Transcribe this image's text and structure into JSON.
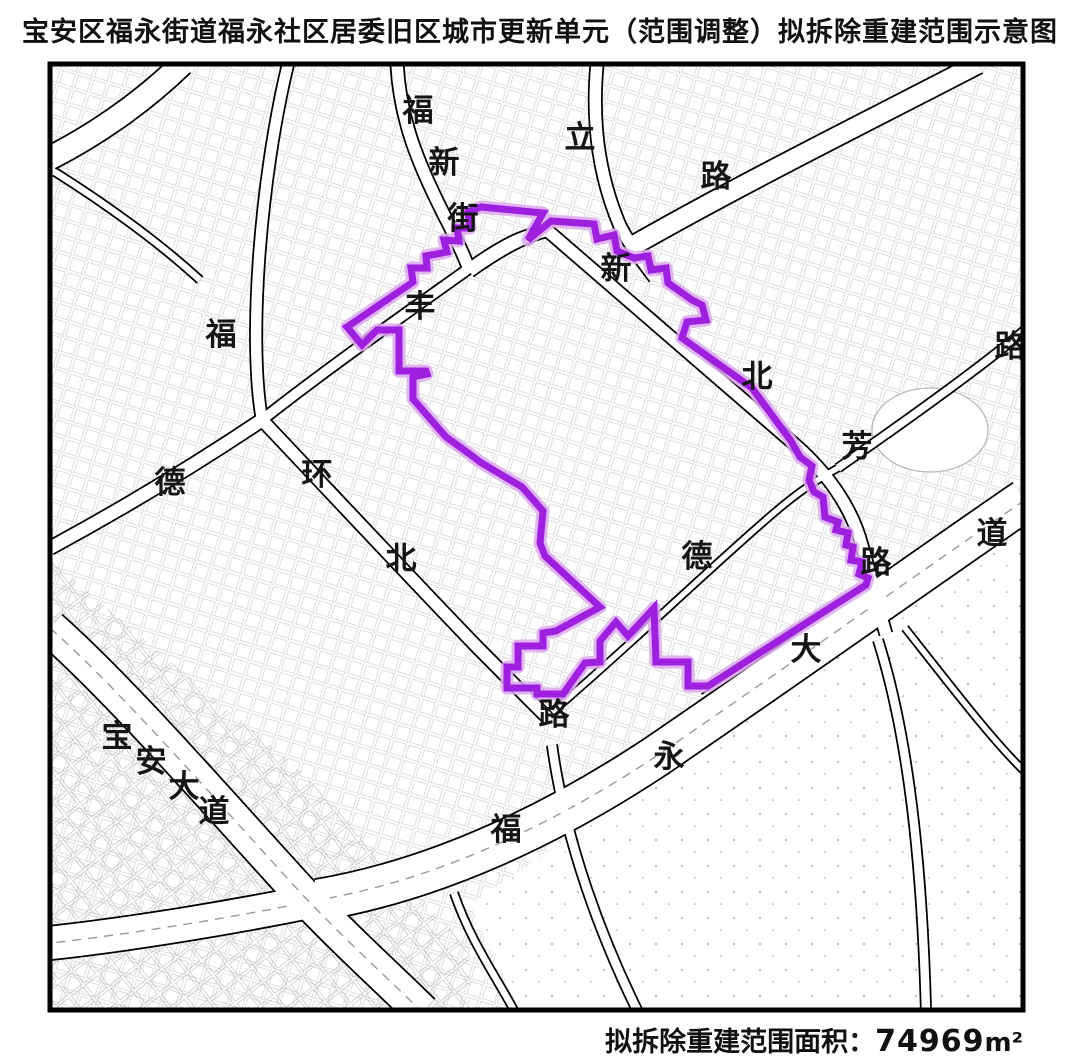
{
  "title": "宝安区福永街道福永社区居委旧区城市更新单元（范围调整）拟拆除重建范围示意图",
  "footer": {
    "area_label": "拟拆除重建范围面积：",
    "area_value": "74969",
    "area_unit": "m²"
  },
  "colors": {
    "boundary_core": "#9F1FDF",
    "boundary_halo": "#DCA8F0",
    "road_casing": "#000000",
    "road_surface": "#ffffff",
    "lane_line": "#999999",
    "label_ink": "#151515"
  },
  "map": {
    "frame": {
      "x": 50,
      "y": 64,
      "width": 973,
      "height": 946
    },
    "boundary": {
      "stroke_width": 7,
      "points": [
        [
          347,
          327
        ],
        [
          413,
          282
        ],
        [
          411,
          268
        ],
        [
          427,
          268
        ],
        [
          426,
          256
        ],
        [
          447,
          252
        ],
        [
          444,
          240
        ],
        [
          459,
          241
        ],
        [
          457,
          228
        ],
        [
          470,
          228
        ],
        [
          468,
          212
        ],
        [
          481,
          207
        ],
        [
          543,
          213
        ],
        [
          528,
          240
        ],
        [
          551,
          221
        ],
        [
          594,
          224
        ],
        [
          597,
          239
        ],
        [
          614,
          235
        ],
        [
          617,
          251
        ],
        [
          634,
          258
        ],
        [
          648,
          256
        ],
        [
          651,
          270
        ],
        [
          666,
          268
        ],
        [
          668,
          283
        ],
        [
          692,
          300
        ],
        [
          702,
          305
        ],
        [
          706,
          320
        ],
        [
          687,
          322
        ],
        [
          682,
          338
        ],
        [
          752,
          388
        ],
        [
          791,
          441
        ],
        [
          800,
          457
        ],
        [
          812,
          466
        ],
        [
          809,
          480
        ],
        [
          814,
          492
        ],
        [
          823,
          497
        ],
        [
          825,
          517
        ],
        [
          838,
          522
        ],
        [
          836,
          530
        ],
        [
          848,
          533
        ],
        [
          846,
          545
        ],
        [
          853,
          547
        ],
        [
          851,
          560
        ],
        [
          862,
          562
        ],
        [
          859,
          574
        ],
        [
          868,
          578
        ],
        [
          866,
          585
        ],
        [
          708,
          686
        ],
        [
          688,
          686
        ],
        [
          688,
          662
        ],
        [
          656,
          662
        ],
        [
          654,
          608
        ],
        [
          642,
          621
        ],
        [
          628,
          636
        ],
        [
          616,
          622
        ],
        [
          600,
          641
        ],
        [
          600,
          662
        ],
        [
          585,
          663
        ],
        [
          563,
          694
        ],
        [
          537,
          694
        ],
        [
          537,
          688
        ],
        [
          507,
          688
        ],
        [
          507,
          667
        ],
        [
          518,
          667
        ],
        [
          518,
          646
        ],
        [
          543,
          646
        ],
        [
          543,
          633
        ],
        [
          556,
          631
        ],
        [
          600,
          607
        ],
        [
          545,
          556
        ],
        [
          540,
          543
        ],
        [
          543,
          511
        ],
        [
          522,
          487
        ],
        [
          480,
          462
        ],
        [
          471,
          455
        ],
        [
          446,
          437
        ],
        [
          413,
          399
        ],
        [
          413,
          377
        ],
        [
          427,
          374
        ],
        [
          426,
          371
        ],
        [
          399,
          371
        ],
        [
          399,
          330
        ],
        [
          377,
          330
        ],
        [
          362,
          345
        ]
      ]
    },
    "roads": [
      {
        "name": "fuyong-avenue-east",
        "d": "M1025,500 C930,565 790,665 655,757 C540,833 425,882 318,900",
        "w": 44,
        "lane": true
      },
      {
        "name": "fuyong-avenue-west",
        "d": "M318,900 C240,916 140,933 50,943",
        "w": 36,
        "lane": true
      },
      {
        "name": "baoan-avenue",
        "d": "M50,628 C125,695 220,805 298,890 C348,943 392,982 422,1012",
        "w": 38,
        "lane": true
      },
      {
        "name": "top-left-corner-road",
        "d": "M182,64 C150,95 105,130 50,158",
        "w": 26,
        "lane": false
      },
      {
        "name": "fuxin-street",
        "d": "M397,64 C400,120 418,163 443,213 C456,238 464,255 470,272",
        "w": 15,
        "lane": false
      },
      {
        "name": "fuxin-connector",
        "d": "M470,272 C498,252 522,238 548,231",
        "w": 13,
        "lane": false
      },
      {
        "name": "north-vertical-road",
        "d": "M597,64 C592,118 597,172 620,226 C631,247 643,262 655,278",
        "w": 15,
        "lane": false
      },
      {
        "name": "li-road-northeast",
        "d": "M636,244 C745,182 870,120 978,64",
        "w": 22,
        "lane": false
      },
      {
        "name": "west-cross-north",
        "d": "M262,420 C248,340 260,180 288,64",
        "w": 14,
        "lane": false
      },
      {
        "name": "west-edge-branch",
        "d": "M55,172 C115,210 165,248 200,280",
        "w": 10,
        "lane": false
      },
      {
        "name": "feng-road-northeast",
        "d": "M262,420 C330,366 425,300 478,262 C510,240 528,233 548,231",
        "w": 13,
        "lane": false
      },
      {
        "name": "de-road-southwest",
        "d": "M262,420 C195,465 120,510 50,548",
        "w": 16,
        "lane": false
      },
      {
        "name": "huanbei-road",
        "d": "M262,420 C330,492 420,588 478,648 C512,682 532,703 550,720",
        "w": 15,
        "lane": false
      },
      {
        "name": "xinbei-fang-road",
        "d": "M548,231 C625,297 725,385 792,442 C828,473 852,508 862,546 C870,573 877,605 886,634",
        "w": 15,
        "lane": false
      },
      {
        "name": "fang-road-northeast",
        "d": "M838,468 C900,425 975,372 1025,330",
        "w": 11,
        "lane": false
      },
      {
        "name": "de-middle-road",
        "d": "M552,712 C625,650 700,577 768,518 C800,490 820,478 838,468",
        "w": 9,
        "lane": false
      },
      {
        "name": "avenue-service-road",
        "d": "M700,692 C760,652 820,612 872,582",
        "w": 7,
        "lane": false
      },
      {
        "name": "bottom-center-road",
        "d": "M552,745 C565,840 600,935 638,1012",
        "w": 12,
        "lane": false
      },
      {
        "name": "bottom-left-road",
        "d": "M454,893 C470,940 495,975 515,1012",
        "w": 10,
        "lane": false
      },
      {
        "name": "bottom-right-road",
        "d": "M878,640 C908,735 922,860 926,1012",
        "w": 12,
        "lane": false
      },
      {
        "name": "southeast-corner-road",
        "d": "M905,628 C950,685 992,740 1025,772",
        "w": 9,
        "lane": false
      }
    ],
    "labels": [
      {
        "text": "福",
        "x": 418,
        "y": 110
      },
      {
        "text": "新",
        "x": 444,
        "y": 162
      },
      {
        "text": "街",
        "x": 463,
        "y": 218
      },
      {
        "text": "立",
        "x": 580,
        "y": 137
      },
      {
        "text": "路",
        "x": 716,
        "y": 176
      },
      {
        "text": "新",
        "x": 616,
        "y": 268
      },
      {
        "text": "丰",
        "x": 420,
        "y": 306
      },
      {
        "text": "福",
        "x": 221,
        "y": 334
      },
      {
        "text": "北",
        "x": 757,
        "y": 376
      },
      {
        "text": "路",
        "x": 1010,
        "y": 346
      },
      {
        "text": "芳",
        "x": 857,
        "y": 446
      },
      {
        "text": "德",
        "x": 170,
        "y": 482
      },
      {
        "text": "环",
        "x": 317,
        "y": 474
      },
      {
        "text": "道",
        "x": 992,
        "y": 533
      },
      {
        "text": "北",
        "x": 401,
        "y": 558
      },
      {
        "text": "德",
        "x": 697,
        "y": 556
      },
      {
        "text": "路",
        "x": 876,
        "y": 562
      },
      {
        "text": "大",
        "x": 806,
        "y": 649
      },
      {
        "text": "路",
        "x": 554,
        "y": 714
      },
      {
        "text": "永",
        "x": 669,
        "y": 756
      },
      {
        "text": "宝",
        "x": 117,
        "y": 736
      },
      {
        "text": "安",
        "x": 151,
        "y": 761
      },
      {
        "text": "大",
        "x": 184,
        "y": 786
      },
      {
        "text": "道",
        "x": 214,
        "y": 811
      },
      {
        "text": "福",
        "x": 506,
        "y": 829
      }
    ]
  }
}
